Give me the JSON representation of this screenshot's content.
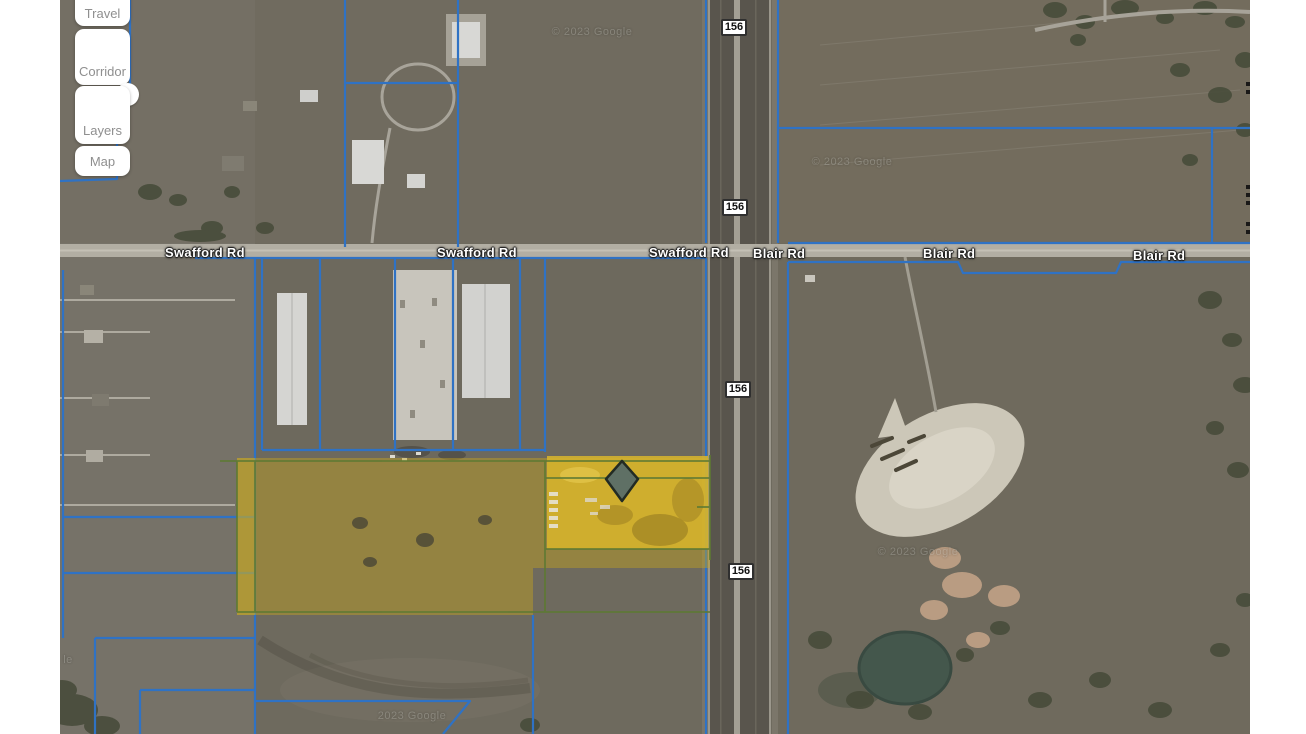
{
  "sidebar": {
    "buttons": [
      {
        "label": "Travel"
      },
      {
        "label": "Corridor"
      },
      {
        "label": "Layers"
      },
      {
        "label": "Map"
      }
    ]
  },
  "map": {
    "road_labels": [
      {
        "text": "Swafford Rd"
      },
      {
        "text": "Swafford Rd"
      },
      {
        "text": "Swafford Rd"
      },
      {
        "text": "Blair Rd"
      },
      {
        "text": "Blair Rd"
      },
      {
        "text": "Blair Rd"
      }
    ],
    "highway_shields": [
      {
        "text": "156"
      },
      {
        "text": "156"
      },
      {
        "text": "156"
      },
      {
        "text": "156"
      }
    ],
    "watermarks": [
      {
        "text": "© 2023 Google"
      },
      {
        "text": "© 2023 Google"
      },
      {
        "text": "© 2023 Google"
      },
      {
        "text": "2023 Google"
      },
      {
        "text": "le"
      }
    ],
    "colors": {
      "parcel_line": "#2f72c4",
      "selection_boundary": "#5e7a33",
      "selection_fill": "#d9b62c",
      "marker_fill": "#5f7065",
      "road_fill": "#b2aea3",
      "highway_fill": "#59554d"
    }
  }
}
